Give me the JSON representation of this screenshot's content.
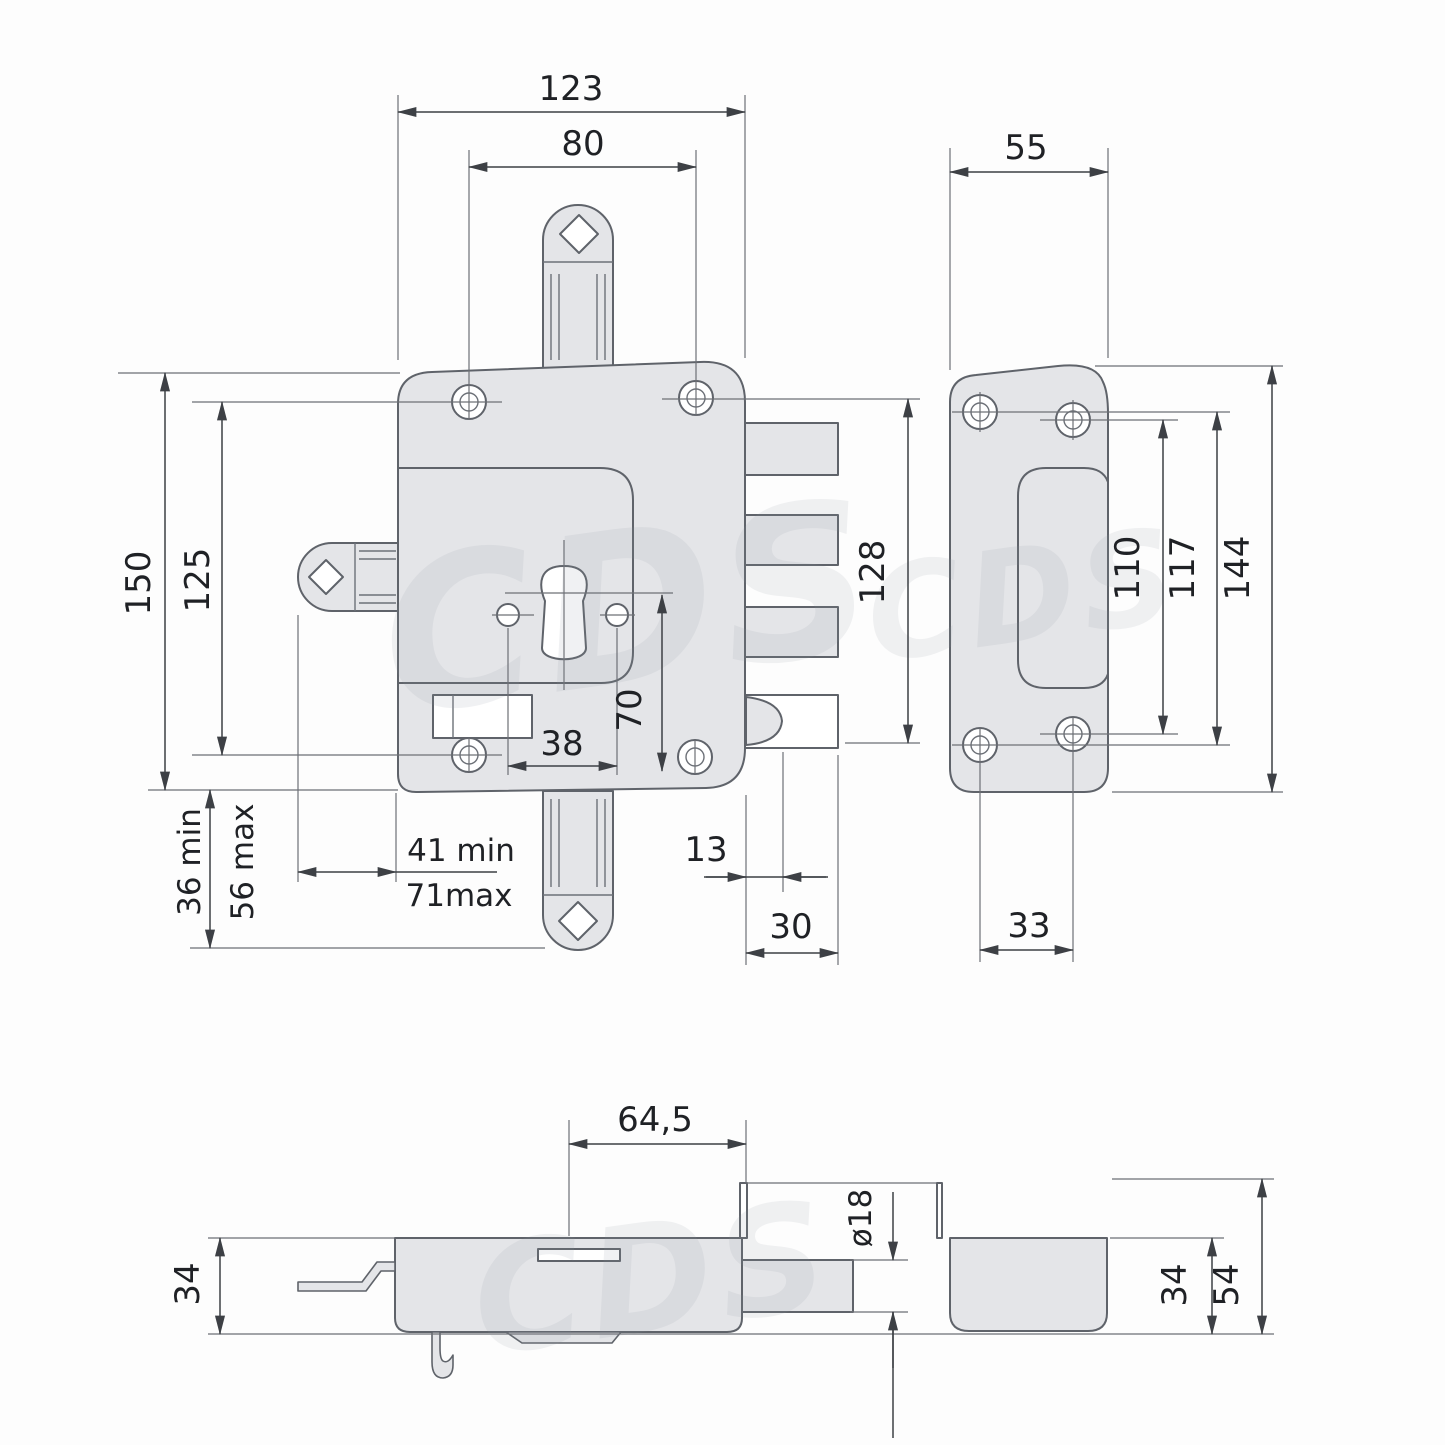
{
  "watermark": {
    "text": "CDS"
  },
  "dims": {
    "front_width": "123",
    "top_hole_spacing": "80",
    "front_height": "150",
    "screw_vertical_spacing": "125",
    "spindle_min": "36 min",
    "spindle_max": "56 max",
    "backset_min": "41 min",
    "backset_max": "71max",
    "cylinder_screw_spacing": "38",
    "cylinder_offset": "70",
    "bolt_span": "128",
    "latch_offset": "13",
    "bolt_throw": "30",
    "plate_width": "55",
    "plate_hole_span_inner": "110",
    "plate_hole_span_outer": "117",
    "plate_height": "144",
    "plate_hole_spacing": "33",
    "section_backset": "64,5",
    "bolt_diameter": "ø18",
    "body_depth": "34",
    "box_inner_depth": "34",
    "box_total_depth": "54"
  }
}
